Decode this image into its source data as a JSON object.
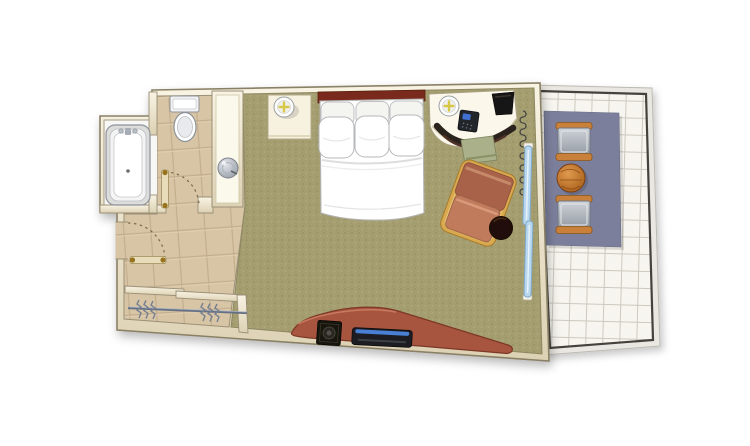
{
  "page": {
    "kind": "floor-plan-illustration",
    "description": "hotel-guest-room-floor-plan"
  },
  "colors": {
    "background": "#ffffff",
    "wall_fill": "#f3ecd9",
    "wall_edge": "#8a8066",
    "carpet": "#a49e71",
    "bathroom_tile": "#d8c5a6",
    "tile_grout": "#c3ad8c",
    "alcove_floor": "#f7f7f5",
    "balcony_tile": "#f7f5ef",
    "balcony_grid": "#ccc9bf",
    "balcony_rail": "#45423c",
    "rug": "#7b7f9c",
    "bed_linen": "#ffffff",
    "headboard": "#7a2b1c",
    "console_wood": "#a85540",
    "console_edge": "#7c3826",
    "tv_body": "#15130f",
    "media_stripe": "#4a7fd4",
    "armchair_frame": "#d9a94f",
    "armchair_back_cushion": "#a86248",
    "armchair_seat_cushion": "#c07a5c",
    "side_table": "#241007",
    "desk_chair": "#2c241e",
    "desk_cushion": "#a9b08a",
    "sliding_door_glass": "#b9d7ee",
    "sliding_door_frame": "#7fa9cb",
    "balcony_wood": "#c06f28",
    "balcony_chair_arm": "#c9803a",
    "balcony_chair_seat": "#b0b5bc",
    "lamp_star": "#d8c84a",
    "door_leaf": "#e9dcba",
    "door_hinge": "#96731d",
    "fixture_white": "#ffffff",
    "fixture_edge": "#8d939b",
    "hanger_metal": "#76808f",
    "curtain_line": "#3f3f3f"
  },
  "floorplan": {
    "rooms": [
      {
        "id": "bathroom",
        "name": "bathroom"
      },
      {
        "id": "bedroom",
        "name": "bedroom"
      },
      {
        "id": "closet",
        "name": "closet"
      },
      {
        "id": "balcony",
        "name": "balcony"
      }
    ],
    "furniture": [
      {
        "id": "bathtub",
        "room": "bathroom"
      },
      {
        "id": "toilet",
        "room": "bathroom"
      },
      {
        "id": "vanity-sink",
        "room": "bathroom"
      },
      {
        "id": "bathroom-door",
        "room": "bathroom"
      },
      {
        "id": "entry-door",
        "room": "closet"
      },
      {
        "id": "closet-rod-hangers",
        "room": "closet"
      },
      {
        "id": "nightstand",
        "room": "bedroom"
      },
      {
        "id": "table-lamp",
        "room": "bedroom"
      },
      {
        "id": "double-bed-six-pillows",
        "room": "bedroom"
      },
      {
        "id": "curved-desk",
        "room": "bedroom"
      },
      {
        "id": "desk-lamp",
        "room": "bedroom"
      },
      {
        "id": "telephone",
        "room": "bedroom"
      },
      {
        "id": "ice-bucket",
        "room": "bedroom"
      },
      {
        "id": "desk-chair",
        "room": "bedroom"
      },
      {
        "id": "armchair",
        "room": "bedroom"
      },
      {
        "id": "round-side-table",
        "room": "bedroom"
      },
      {
        "id": "tv-console",
        "room": "bedroom"
      },
      {
        "id": "tv",
        "room": "bedroom"
      },
      {
        "id": "media-player",
        "room": "bedroom"
      },
      {
        "id": "curtain",
        "room": "bedroom"
      },
      {
        "id": "sliding-glass-door",
        "room": "bedroom"
      },
      {
        "id": "balcony-rug",
        "room": "balcony"
      },
      {
        "id": "balcony-chair-top",
        "room": "balcony"
      },
      {
        "id": "balcony-chair-bottom",
        "room": "balcony"
      },
      {
        "id": "balcony-round-table",
        "room": "balcony"
      }
    ]
  }
}
